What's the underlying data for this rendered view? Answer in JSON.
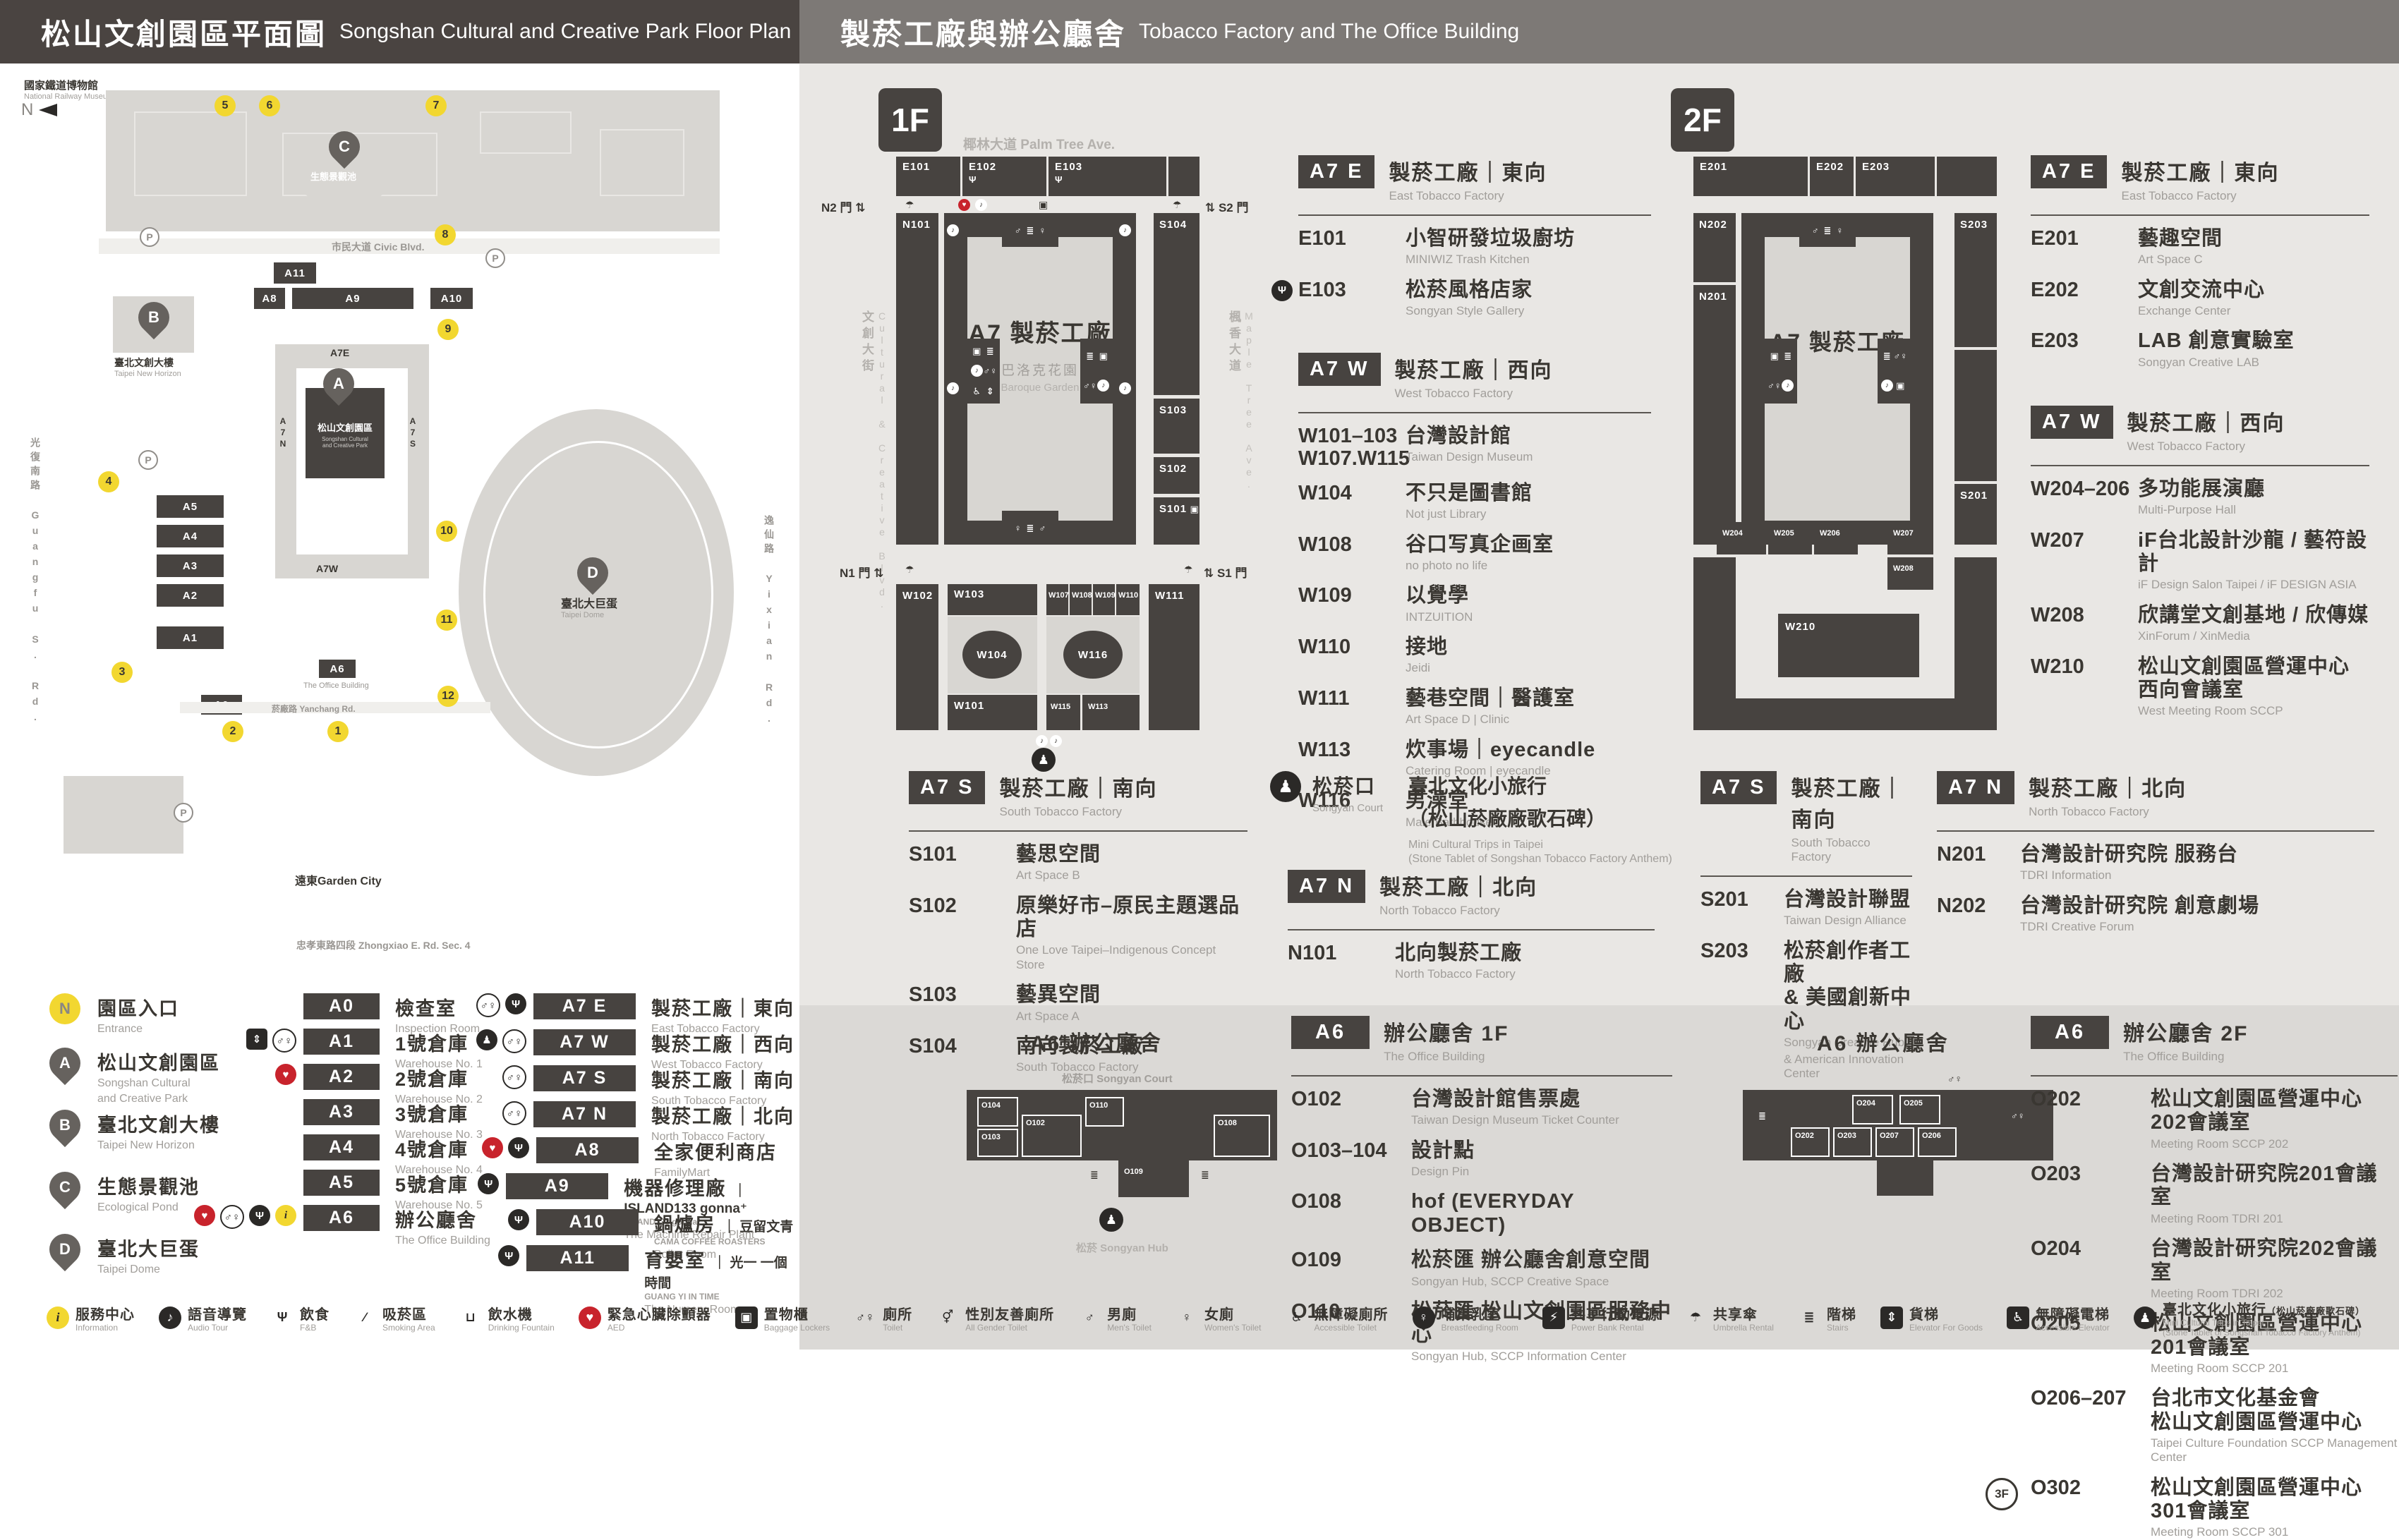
{
  "header": {
    "left_zh": "松山文創園區平面圖",
    "left_en": "Songshan Cultural and Creative Park Floor Plan",
    "right_zh": "製菸工廠與辦公廳舍",
    "right_en": "Tobacco Factory and The Office Building"
  },
  "colors": {
    "dark": "#474340",
    "yellow": "#f2d730",
    "red": "#c8232c"
  },
  "map": {
    "north": "N",
    "museum_zh": "國家鐵道博物館",
    "museum_en": "National Railway Museum",
    "street_top": "市民大道 Civic Blvd.",
    "street_left": "光復南路 Guangfu S. Rd.",
    "street_bottom": "忠孝東路四段 Zhongxiao E. Rd. Sec. 4",
    "street_right": "逸仙路 Yixian Rd.",
    "street_inner": "菸廠路 Yanchang Rd.",
    "center_zh": "松山文創園區",
    "center_en1": "Songshan Cultural",
    "center_en2": "and Creative Park",
    "eslite_zh": "臺北文創大樓",
    "eslite_en": "Taipei New Horizon",
    "pond_zh": "生態景觀池",
    "dome_zh": "臺北大巨蛋",
    "dome_en": "Taipei Dome",
    "garden_city": "遠東Garden City",
    "office_en": "The Office Building",
    "p": "P",
    "blocks": {
      "a0": "A0",
      "a1": "A1",
      "a2": "A2",
      "a3": "A3",
      "a4": "A4",
      "a5": "A5",
      "a6": "A6",
      "a7e": "A7E",
      "a7w": "A7W",
      "a7n": "A7N",
      "a7s": "A7S",
      "a8": "A8",
      "a9": "A9",
      "a10": "A10",
      "a11": "A11"
    },
    "pins": {
      "a": "A",
      "b": "B",
      "c": "C",
      "d": "D"
    },
    "gates": [
      "1",
      "2",
      "3",
      "4",
      "5",
      "6",
      "7",
      "8",
      "9",
      "10",
      "11",
      "12"
    ]
  },
  "floor1": {
    "fbadge": "1F",
    "misc": {
      "ave_top": "椰林大道 Palm Tree Ave.",
      "ave_left": "文創大街",
      "ave_left_en": "Cultural & Creative Blvd.",
      "ave_right": "楓香大道",
      "ave_right_en": "Maple Tree Ave.",
      "n2": "N2 門",
      "s2": "S2 門",
      "n1": "N1 門",
      "s1": "S1 門",
      "center": "A7 製菸工廠",
      "garden_zh": "巴洛克花園",
      "garden_en": "Baroque Garden"
    },
    "plan": {
      "e101": "E101",
      "e102": "E102",
      "e103": "E103",
      "n101": "N101",
      "s101": "S101",
      "s102": "S102",
      "s103": "S103",
      "s104": "S104",
      "w101": "W101",
      "w102": "W102",
      "w103": "W103",
      "w104": "W104",
      "w107": "W107",
      "w108": "W108",
      "w109": "W109",
      "w110": "W110",
      "w111": "W111",
      "w113": "W113",
      "w115": "W115",
      "w116": "W116"
    },
    "sections": {
      "east": {
        "badge": "A7 E",
        "title_zh": "製菸工廠｜東向",
        "title_en": "East Tobacco Factory",
        "rooms": [
          {
            "code": "E101",
            "zh": "小智研發垃圾廚坊",
            "en": "MINIWIZ Trash Kitchen",
            "icons": []
          },
          {
            "code": "E103",
            "zh": "松菸風格店家",
            "en": "Songyan Style Gallery",
            "icons": [
              "fnb"
            ]
          }
        ]
      },
      "west": {
        "badge": "A7 W",
        "title_zh": "製菸工廠｜西向",
        "title_en": "West Tobacco Factory",
        "rooms": [
          {
            "code": "W101–103",
            "code2": "W107.W115",
            "zh": "台灣設計館",
            "en": "Taiwan Design Museum",
            "icons": []
          },
          {
            "code": "W104",
            "zh": "不只是圖書館",
            "en": "Not just Library",
            "icons": []
          },
          {
            "code": "W108",
            "zh": "谷口写真企画室",
            "en": "no photo no life",
            "icons": []
          },
          {
            "code": "W109",
            "zh": "以覺學",
            "en": "INTZUITION",
            "icons": []
          },
          {
            "code": "W110",
            "zh": "接地",
            "en": "Jeidi",
            "icons": []
          },
          {
            "code": "W111",
            "zh": "藝巷空間｜醫護室",
            "en": "Art Space D | Clinic",
            "icons": []
          },
          {
            "code": "W113",
            "zh": "炊事場｜eyecandle",
            "en": "Catering Room | eyecandle",
            "icons": []
          },
          {
            "code": "W116",
            "zh": "男澡堂",
            "en": "Male Bathhouse",
            "icons": []
          }
        ]
      },
      "south": {
        "badge": "A7 S",
        "title_zh": "製菸工廠｜南向",
        "title_en": "South Tobacco Factory",
        "rooms": [
          {
            "code": "S101",
            "zh": "藝思空間",
            "en": "Art Space B",
            "icons": []
          },
          {
            "code": "S102",
            "zh": "原樂好市–原民主題選品店",
            "en": "One Love Taipei–Indigenous Concept Store",
            "icons": []
          },
          {
            "code": "S103",
            "zh": "藝異空間",
            "en": "Art Space A",
            "icons": []
          },
          {
            "code": "S104",
            "zh": "南向製菸工廠",
            "en": "South Tobacco Factory",
            "icons": []
          }
        ]
      },
      "north": {
        "badge": "A7 N",
        "title_zh": "製菸工廠｜北向",
        "title_en": "North Tobacco Factory",
        "rooms": [
          {
            "code": "N101",
            "zh": "北向製菸工廠",
            "en": "North Tobacco Factory",
            "icons": []
          }
        ]
      }
    },
    "court": {
      "zh": "松菸口",
      "en": "Songyan Court",
      "t_zh": "臺北文化小旅行",
      "t_zh2": "（松山菸廠廠歌石碑）",
      "t_en": "Mini Cultural Trips in Taipei",
      "t_en2": "(Stone Tablet of Songshan Tobacco Factory Anthem)"
    }
  },
  "floor2": {
    "fbadge": "2F",
    "misc": {
      "center": "A7 製菸工廠"
    },
    "plan": {
      "e201": "E201",
      "e202": "E202",
      "e203": "E203",
      "n201": "N201",
      "n202": "N202",
      "s201": "S201",
      "s203": "S203",
      "w204": "W204",
      "w205": "W205",
      "w206": "W206",
      "w207": "W207",
      "w208": "W208",
      "w210": "W210"
    },
    "sections": {
      "east": {
        "badge": "A7 E",
        "title_zh": "製菸工廠｜東向",
        "title_en": "East Tobacco Factory",
        "rooms": [
          {
            "code": "E201",
            "zh": "藝趣空間",
            "en": "Art Space C",
            "icons": []
          },
          {
            "code": "E202",
            "zh": "文創交流中心",
            "en": "Exchange Center",
            "icons": []
          },
          {
            "code": "E203",
            "zh": "LAB 創意實驗室",
            "en": "Songyan Creative LAB",
            "icons": []
          }
        ]
      },
      "west": {
        "badge": "A7 W",
        "title_zh": "製菸工廠｜西向",
        "title_en": "West Tobacco Factory",
        "rooms": [
          {
            "code": "W204–206",
            "zh": "多功能展演廳",
            "en": "Multi-Purpose Hall",
            "icons": []
          },
          {
            "code": "W207",
            "zh": "iF台北設計沙龍 / 藝符設計",
            "en": "iF Design Salon Taipei / iF DESIGN ASIA",
            "icons": []
          },
          {
            "code": "W208",
            "zh": "欣講堂文創基地 / 欣傳媒",
            "en": "XinForum / XinMedia",
            "icons": []
          },
          {
            "code": "W210",
            "zh": "松山文創園區營運中心",
            "zh2": "西向會議室",
            "en": "West Meeting Room SCCP",
            "icons": []
          }
        ]
      },
      "south": {
        "badge": "A7 S",
        "title_zh": "製菸工廠｜南向",
        "title_en": "South Tobacco Factory",
        "rooms": [
          {
            "code": "S201",
            "zh": "台灣設計聯盟",
            "en": "Taiwan Design Alliance",
            "icons": []
          },
          {
            "code": "S203",
            "zh": "松菸創作者工廠",
            "zh2": "& 美國創新中心",
            "en": "Songyan Creative Hub",
            "en2": "& American Innovation Center",
            "icons": []
          }
        ]
      },
      "north": {
        "badge": "A7 N",
        "title_zh": "製菸工廠｜北向",
        "title_en": "North Tobacco Factory",
        "rooms": [
          {
            "code": "N201",
            "zh": "台灣設計研究院 服務台",
            "en": "TDRI Information",
            "icons": []
          },
          {
            "code": "N202",
            "zh": "台灣設計研究院 創意劇場",
            "en": "TDRI Creative Forum",
            "icons": []
          }
        ]
      }
    }
  },
  "office1f": {
    "badge": "A6",
    "title_zh": "辦公廳舍 1F",
    "title_en": "The Office Building",
    "misc": {
      "title": "A6 辦公廳舍",
      "court": "松菸口 Songyan Court",
      "hub": "松菸 Songyan Hub"
    },
    "plan": {
      "o102": "O102",
      "o103": "O103",
      "o104": "O104",
      "o108": "O108",
      "o109": "O109",
      "o110": "O110"
    },
    "list": [
      {
        "code": "O102",
        "zh": "台灣設計館售票處",
        "en": "Taiwan Design Museum Ticket Counter",
        "icons": []
      },
      {
        "code": "O103–104",
        "zh": "設計點",
        "en": "Design Pin",
        "icons": []
      },
      {
        "code": "O108",
        "zh": "hof (EVERYDAY OBJECT)",
        "en": "",
        "icons": []
      },
      {
        "code": "O109",
        "zh": "松菸匯 辦公廳舍創意空間",
        "en": "Songyan Hub, SCCP Creative Space",
        "icons": []
      },
      {
        "code": "O110",
        "zh": "松菸匯 松山文創園區服務中心",
        "en": "Songyan Hub, SCCP Information Center",
        "icons": []
      }
    ]
  },
  "office2f": {
    "badge": "A6",
    "title_zh": "辦公廳舍 2F",
    "title_en": "The Office Building",
    "misc": {
      "title": "A6 辦公廳舍"
    },
    "plan": {
      "o202": "O202",
      "o203": "O203",
      "o204": "O204",
      "o205": "O205",
      "o206": "O206",
      "o207": "O207"
    },
    "list": [
      {
        "code": "O202",
        "zh": "松山文創園區營運中心202會議室",
        "en": "Meeting Room SCCP 202",
        "icons": []
      },
      {
        "code": "O203",
        "zh": "台灣設計研究院201會議室",
        "en": "Meeting Room TDRI 201",
        "icons": []
      },
      {
        "code": "O204",
        "zh": "台灣設計研究院202會議室",
        "en": "Meeting Room TDRI 202",
        "icons": []
      },
      {
        "code": "O205",
        "zh": "松山文創園區營運中心201會議室",
        "en": "Meeting Room SCCP 201",
        "icons": []
      },
      {
        "code": "O206–207",
        "zh": "台北市文化基金會",
        "zh2": "松山文創園區營運中心",
        "en": "Taipei Culture Foundation SCCP Management Center",
        "icons": []
      },
      {
        "pre": "3F",
        "code": "O302",
        "zh": "松山文創園區營運中心301會議室",
        "en": "Meeting Room SCCP 301",
        "icons": []
      }
    ]
  },
  "legend": {
    "entrance": {
      "sym": "N",
      "zh": "園區入口",
      "en": "Entrance"
    },
    "pins": [
      {
        "sym": "A",
        "zh": "松山文創園區",
        "en": "Songshan Cultural",
        "en2": "and Creative Park"
      },
      {
        "sym": "B",
        "zh": "臺北文創大樓",
        "en": "Taipei New Horizon",
        "en2": ""
      },
      {
        "sym": "C",
        "zh": "生態景觀池",
        "en": "Ecological Pond",
        "en2": ""
      },
      {
        "sym": "D",
        "zh": "臺北大巨蛋",
        "en": "Taipei Dome",
        "en2": ""
      }
    ],
    "buildings": [
      {
        "badge": "A0",
        "zh": "檢查室",
        "en": "Inspection Room",
        "icons": []
      },
      {
        "badge": "A1",
        "zh": "1號倉庫",
        "en": "Warehouse No. 1",
        "icons": [
          "elevator",
          "toilet"
        ]
      },
      {
        "badge": "A2",
        "zh": "2號倉庫",
        "en": "Warehouse No. 2",
        "icons": [
          "aed"
        ]
      },
      {
        "badge": "A3",
        "zh": "3號倉庫",
        "en": "Warehouse No. 3",
        "icons": []
      },
      {
        "badge": "A4",
        "zh": "4號倉庫",
        "en": "Warehouse No. 4",
        "icons": []
      },
      {
        "badge": "A5",
        "zh": "5號倉庫",
        "en": "Warehouse No. 5",
        "icons": []
      },
      {
        "badge": "A6",
        "zh": "辦公廳舍",
        "en": "The Office Building",
        "icons": [
          "aed",
          "toilet",
          "fnb",
          "information"
        ]
      }
    ],
    "factory": [
      {
        "badge": "A7 E",
        "zh": "製菸工廠｜東向",
        "en": "East Tobacco Factory",
        "brand": "",
        "brandsub": "",
        "icons": [
          "toilet",
          "fnb"
        ]
      },
      {
        "badge": "A7 W",
        "zh": "製菸工廠｜西向",
        "en": "West Tobacco Factory",
        "brand": "",
        "brandsub": "",
        "icons": [
          "person",
          "toilet"
        ]
      },
      {
        "badge": "A7 S",
        "zh": "製菸工廠｜南向",
        "en": "South Tobacco Factory",
        "brand": "",
        "brandsub": "",
        "icons": [
          "toilet"
        ]
      },
      {
        "badge": "A7 N",
        "zh": "製菸工廠｜北向",
        "en": "North Tobacco Factory",
        "brand": "",
        "brandsub": "",
        "icons": [
          "toilet"
        ]
      },
      {
        "badge": "A8",
        "zh": "全家便利商店",
        "en": "FamilyMart",
        "brand": "",
        "brandsub": "",
        "icons": [
          "aed",
          "fnb"
        ]
      },
      {
        "badge": "A9",
        "zh": "機器修理廠",
        "en": "The Machine Repair Plant",
        "brand": "｜ ISLAND133 gonna⁺",
        "brandsub": "ISLAND133 gonna⁺",
        "icons": [
          "fnb"
        ]
      },
      {
        "badge": "A10",
        "zh": "鍋爐房",
        "en": "Boiler Room",
        "brand": "｜ 豆留文青",
        "brandsub": "CAMA COFFEE ROASTERS",
        "icons": [
          "fnb"
        ]
      },
      {
        "badge": "A11",
        "zh": "育嬰室",
        "en": "The Nursery Room",
        "brand": "｜ 光一 一個時間",
        "brandsub": "GUANG YI IN TIME",
        "icons": [
          "fnb"
        ]
      }
    ]
  },
  "icon_strip": [
    {
      "icon": "information",
      "zh": "服務中心",
      "en": "Information"
    },
    {
      "icon": "audio-tour",
      "zh": "語音導覽",
      "en": "Audio Tour"
    },
    {
      "icon": "fnb",
      "zh": "飲食",
      "en": "F&B"
    },
    {
      "icon": "smoking",
      "zh": "吸菸區",
      "en": "Smoking Area"
    },
    {
      "icon": "water",
      "zh": "飲水機",
      "en": "Drinking Fountain"
    },
    {
      "icon": "aed",
      "zh": "緊急心臟除顫器",
      "en": "AED"
    },
    {
      "icon": "locker",
      "zh": "置物櫃",
      "en": "Baggage Lockers"
    },
    {
      "icon": "toilet",
      "zh": "廁所",
      "en": "Toilet"
    },
    {
      "icon": "all-gender",
      "zh": "性別友善廁所",
      "en": "All Gender Toilet"
    },
    {
      "icon": "mens",
      "zh": "男廁",
      "en": "Men's Toilet"
    },
    {
      "icon": "womens",
      "zh": "女廁",
      "en": "Women's Toilet"
    },
    {
      "icon": "accessible-toilet",
      "zh": "無障礙廁所",
      "en": "Accessible Toilet"
    },
    {
      "icon": "breastfeeding",
      "zh": "哺集乳室",
      "en": "Breastfeeding Room"
    },
    {
      "icon": "power-bank",
      "zh": "共享行動電源",
      "en": "Power Bank Rental"
    },
    {
      "icon": "umbrella",
      "zh": "共享傘",
      "en": "Umbrella Rental"
    },
    {
      "icon": "stairs",
      "zh": "階梯",
      "en": "Stairs"
    },
    {
      "icon": "goods-elevator",
      "zh": "貨梯",
      "en": "Elevator For Goods"
    },
    {
      "icon": "accessible-elevator",
      "zh": "無障礙電梯",
      "en": "Accessible Elevator"
    },
    {
      "icon": "mini-trip",
      "zh": "臺北文化小旅行",
      "zh_sub": "（松山菸廠廠歌石碑）",
      "en": "Mini Cultural Trips in Taipei",
      "en2": "(Stone Tablet of Songshan Tobacco Factory Anthem)"
    }
  ]
}
